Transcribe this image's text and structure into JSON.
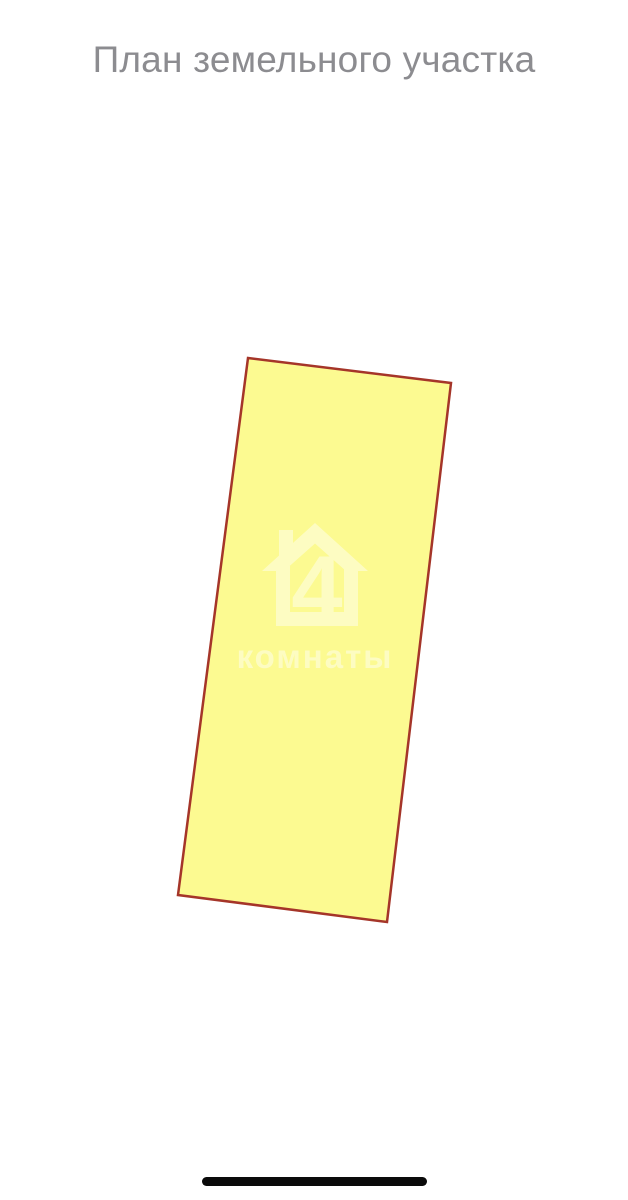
{
  "page": {
    "title": "План земельного участка"
  },
  "colors": {
    "background": "#ffffff",
    "title_text": "#8c8c90",
    "plot_fill": "#fcfa91",
    "plot_border": "#a53529",
    "watermark": "#ffffff",
    "home_indicator": "#0a0a0a"
  },
  "plan": {
    "polygon_points": "248,358 451,383 387,922 178,895",
    "border_width": "2.5",
    "watermark": {
      "brand_number": "4",
      "brand_text": "комнаты",
      "opacity": "0.45"
    }
  }
}
